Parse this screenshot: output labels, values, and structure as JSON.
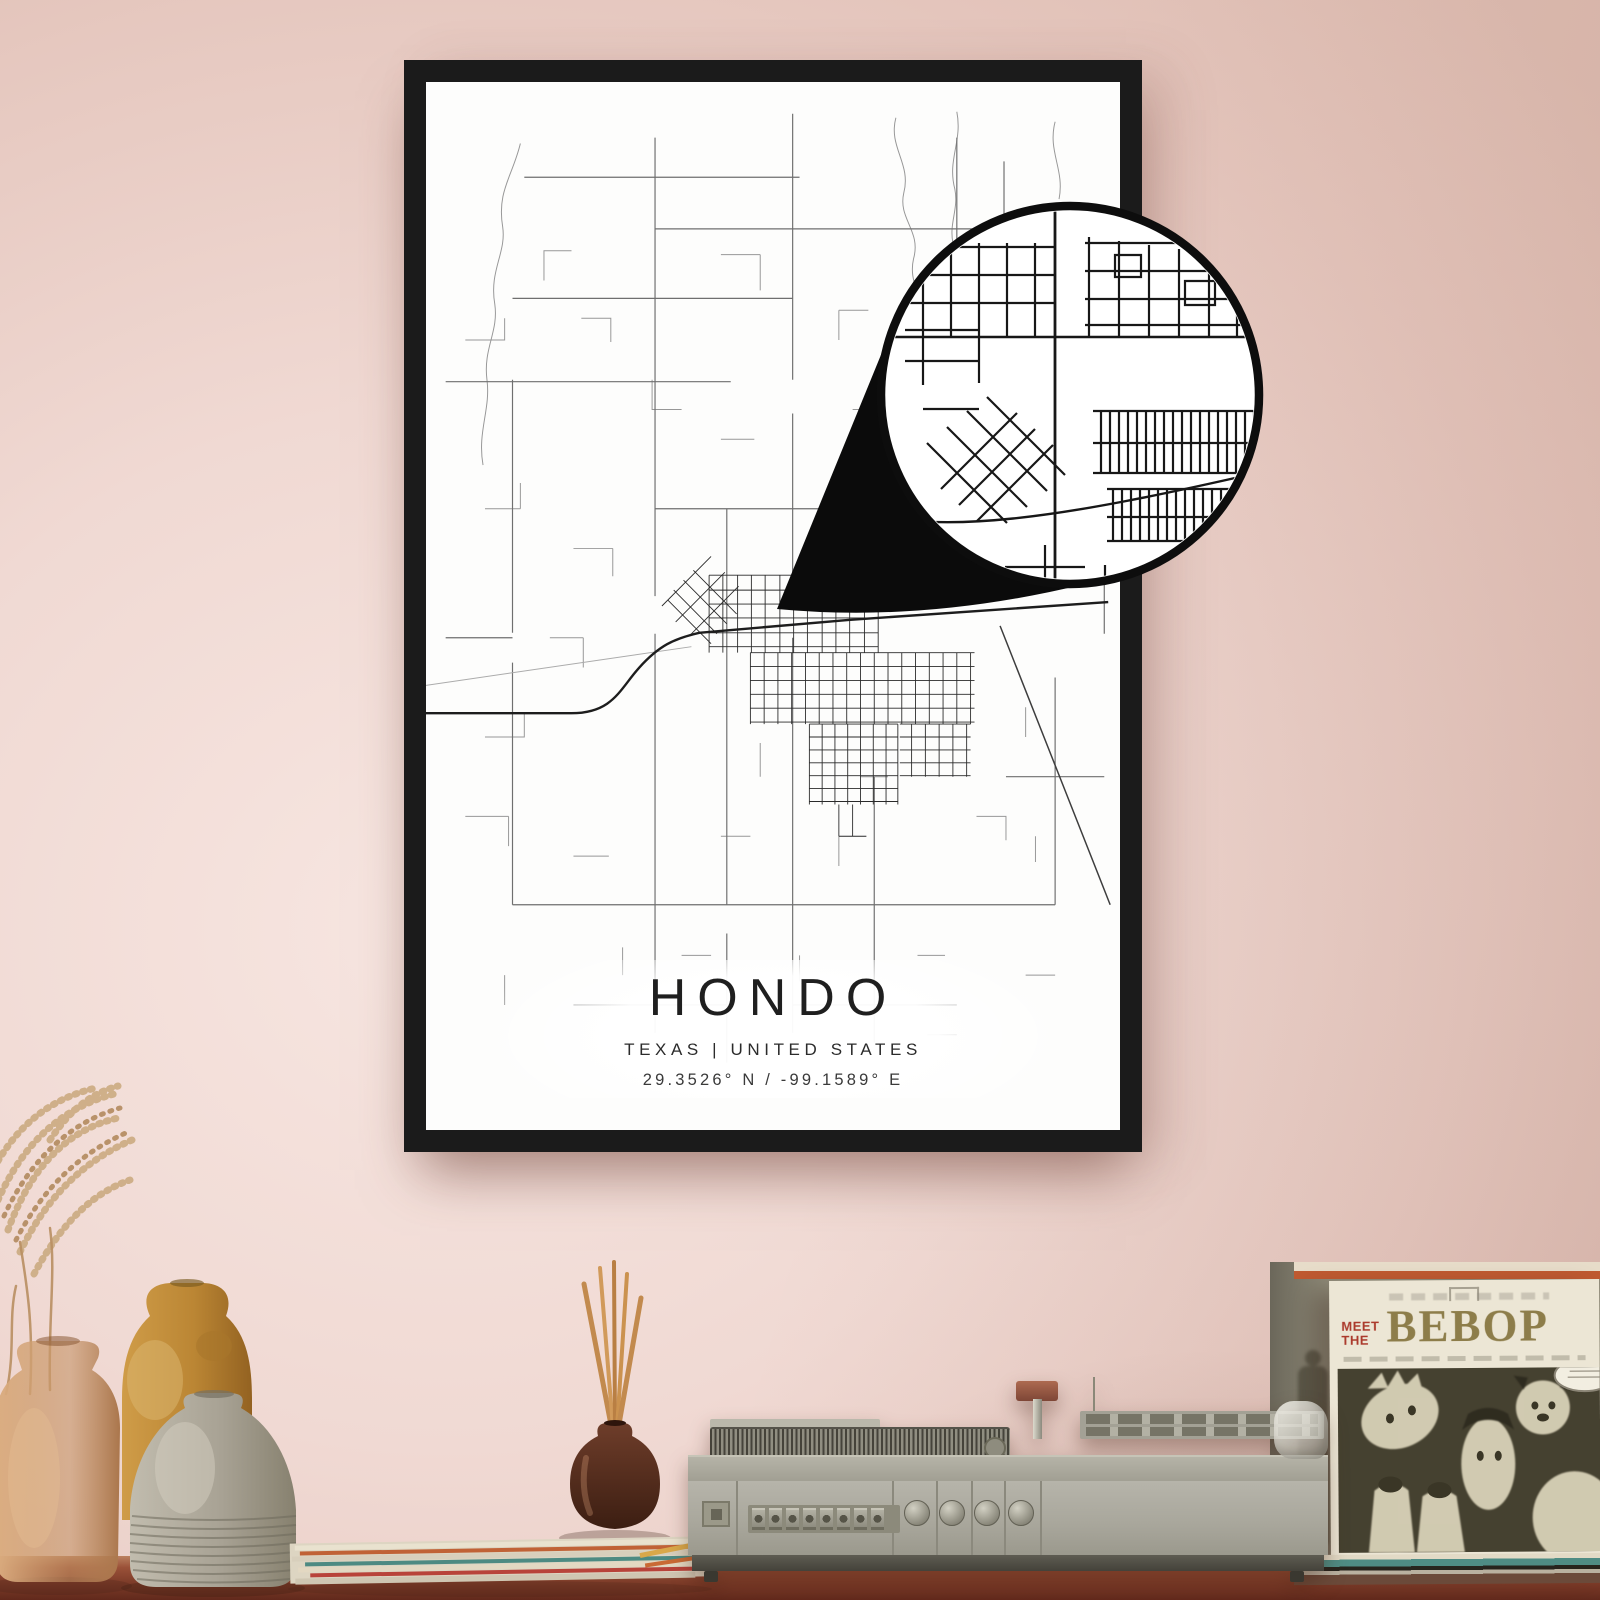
{
  "poster": {
    "title": "HONDO",
    "subtitle": "TEXAS | UNITED STATES",
    "coordinates": "29.3526° N / -99.1589° E",
    "frame_color": "#1b1b1b",
    "paper_color": "#fdfdfc",
    "road_color": "#2e2e2e"
  },
  "callout": {
    "ring_color": "#0d0d0d",
    "fill_color": "#ffffff"
  },
  "record_sleeve": {
    "pretitle_top": "MEET",
    "pretitle_bottom": "THE",
    "title": "BEBOP",
    "pretitle_color": "#ab3a2c",
    "title_color": "#8d7d4a",
    "background_color": "#ece6d5",
    "artwork_color": "#454130"
  },
  "wall": {
    "color": "#ecd2cb"
  },
  "table": {
    "wood_color": "#8d4a33"
  },
  "turntable": {
    "body_color": "#aaa89c",
    "square_buttons": 8,
    "round_knobs": 4
  },
  "decor": {
    "vase_count": 3,
    "diffuser_reed_count": 5
  }
}
